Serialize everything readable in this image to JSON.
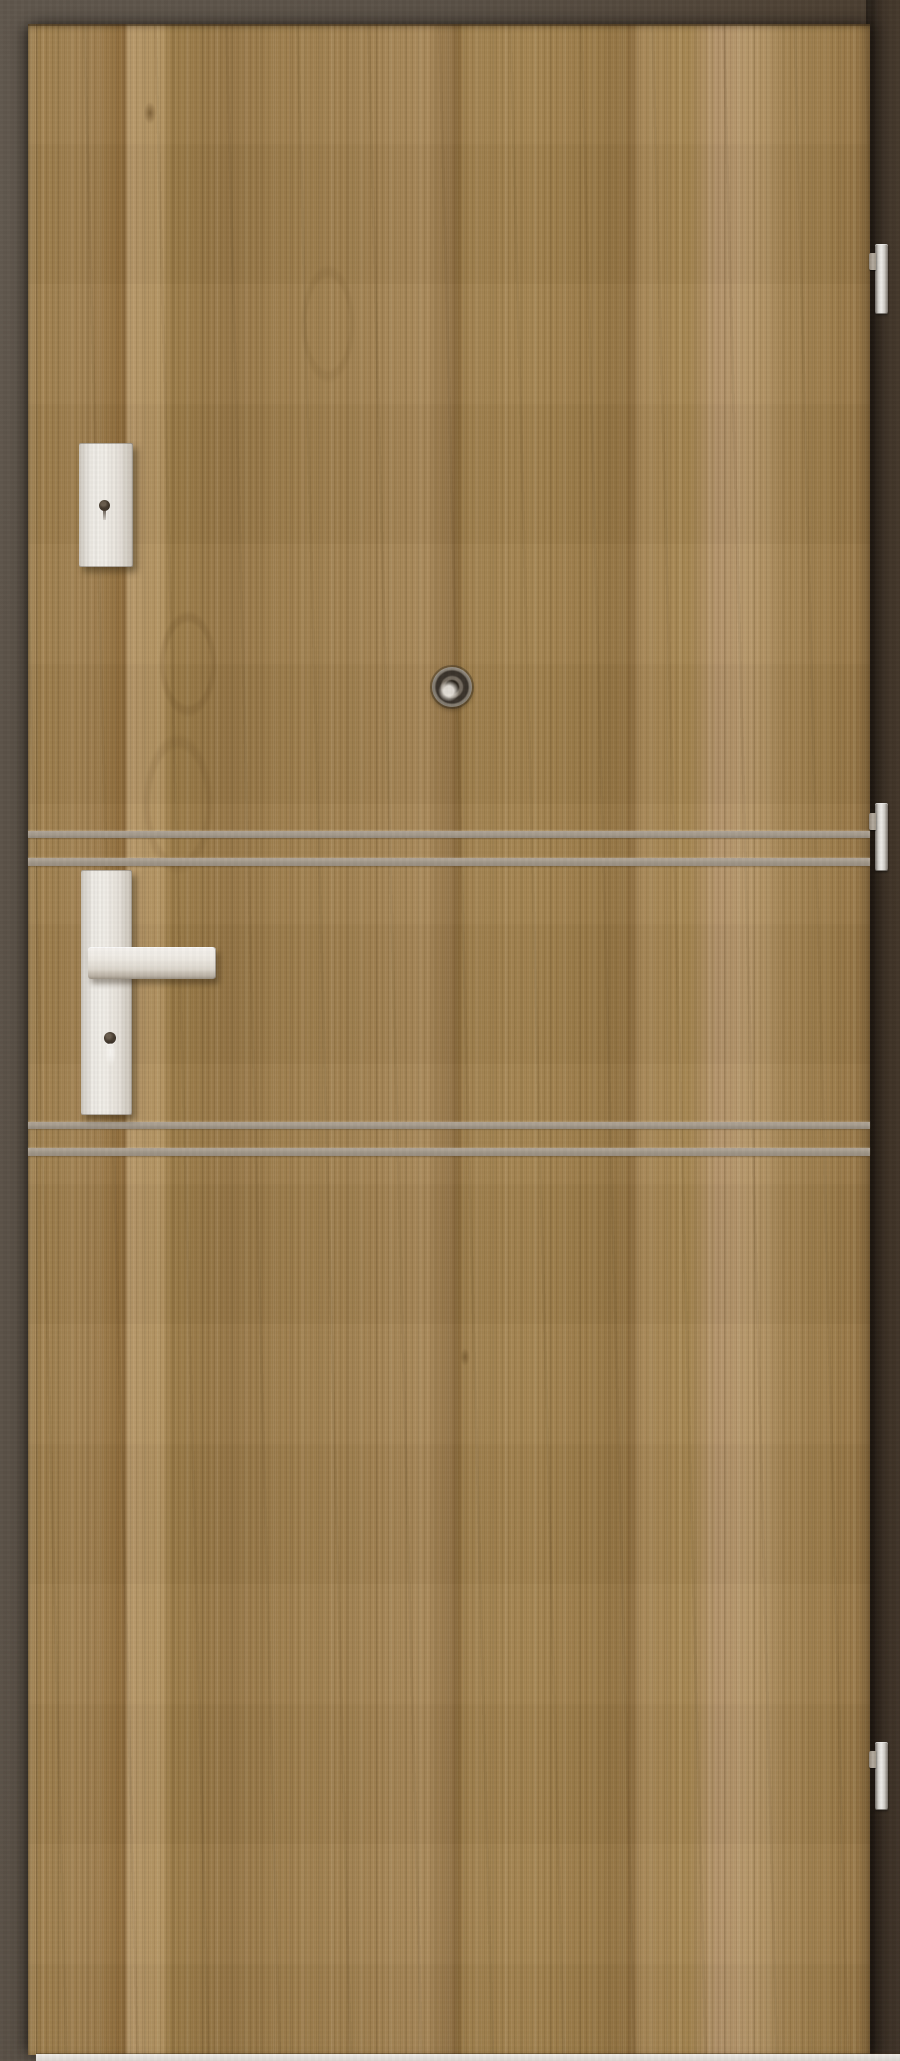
{
  "scene": {
    "label": "Product photo of a wooden interior entrance door, closed, seen straight on",
    "wall": {
      "label": "Dark brown wall and door frame surrounding the door",
      "color_left": "#5c5349",
      "color_right": "#42362a",
      "shadow_color_near_door": "#2a211a"
    },
    "floor_line": {
      "label": "Light floor line visible under the door",
      "color": "#e8e5e1"
    }
  },
  "door": {
    "label": "Door leaf with vertical walnut/oak woodgrain laminate finish",
    "finish": "vertical woodgrain, golden walnut",
    "base_color": "#a28150",
    "grain_dark_color": "#8a683a",
    "grain_light_color": "#b69768",
    "inlay_strips": {
      "label": "Horizontal aluminium intarsia inlay strips across the door",
      "count": 4,
      "color": "#a59b8d",
      "arrangement": "two pairs: one pair above the handle, one pair below the handle"
    }
  },
  "hardware": {
    "upper_lock_plate": {
      "label": "Upper auxiliary lock escutcheon plate with keyhole",
      "color": "#eeebe5",
      "keyhole_color": "#453a2e"
    },
    "handle": {
      "label": "Lever door handle on long backplate with key cylinder below",
      "plate_color": "#eeebe5",
      "lever_color": "#eeeae3",
      "cylinder_color": "#453a2e"
    },
    "peephole": {
      "label": "Round metal door viewer (peephole) at door center",
      "ring_color": "#746b5f",
      "lens_color": "#282219"
    },
    "hinges": {
      "label": "Three silver hinges on the right door edge",
      "count": 3,
      "color": "#d9d6d1"
    }
  }
}
